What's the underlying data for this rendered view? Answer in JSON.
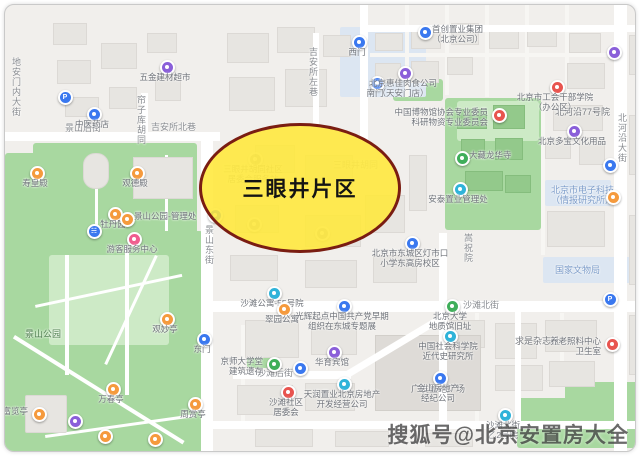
{
  "map": {
    "highlight": {
      "label": "三眼井片区",
      "cx": 292,
      "cy": 180,
      "rx": 98,
      "ry": 62
    },
    "watermark": {
      "text": "搜狐号@北京安置房大全"
    },
    "street_labels": [
      {
        "text": "地安门内大街",
        "x": 6,
        "y": 52,
        "vertical": true
      },
      {
        "text": "帘子库胡同",
        "x": 131,
        "y": 90,
        "vertical": true
      },
      {
        "text": "吉安所左巷",
        "x": 303,
        "y": 42,
        "vertical": true
      },
      {
        "text": "景山后街",
        "x": 60,
        "y": 119,
        "vertical": false
      },
      {
        "text": "吉安所北巷",
        "x": 146,
        "y": 118,
        "vertical": false
      },
      {
        "text": "景山东街",
        "x": 199,
        "y": 220,
        "vertical": true
      },
      {
        "text": "北河沿大街",
        "x": 612,
        "y": 108,
        "vertical": true
      },
      {
        "text": "嵩祝院",
        "x": 458,
        "y": 228,
        "vertical": true
      },
      {
        "text": "沙滩北街",
        "x": 458,
        "y": 296,
        "vertical": false
      },
      {
        "text": "沙滩后街",
        "x": 252,
        "y": 364,
        "vertical": false
      },
      {
        "text": "三眼井胡同",
        "x": 328,
        "y": 156,
        "vertical": false,
        "faint": true
      }
    ],
    "area_labels": [
      {
        "lines": [
          "北河沿77号院"
        ],
        "x": 550,
        "y": 102,
        "color": "label_gray"
      },
      {
        "lines": [
          "北京市电子科技",
          "（情报研究所）"
        ],
        "x": 546,
        "y": 180,
        "color": "label_blue"
      },
      {
        "lines": [
          "国家文物局"
        ],
        "x": 550,
        "y": 260,
        "color": "label_blue"
      },
      {
        "lines": [
          "求是杂志社"
        ],
        "x": 510,
        "y": 331,
        "color": "label_gray"
      },
      {
        "lines": [
          "广发置地广场"
        ],
        "x": 406,
        "y": 379,
        "color": "label_gray"
      },
      {
        "lines": [
          "景山公园"
        ],
        "x": 20,
        "y": 324,
        "color": "label_green"
      }
    ],
    "pois": [
      {
        "x": 58,
        "y": 90,
        "color": "pin_blue",
        "glyph": "P",
        "lines": []
      },
      {
        "x": 87,
        "y": 107,
        "color": "pin_blue",
        "lines": [
          "中医药店"
        ]
      },
      {
        "x": 160,
        "y": 60,
        "color": "pin_purple",
        "lines": [
          "五金建材超市"
        ]
      },
      {
        "x": 352,
        "y": 35,
        "color": "pin_blue",
        "lines": [
          "西门"
        ]
      },
      {
        "x": 370,
        "y": 76,
        "color": "pin_blue",
        "lines": [
          "南门"
        ]
      },
      {
        "x": 398,
        "y": 66,
        "color": "pin_purple",
        "lines": [
          "北京惠佳肉食公司",
          "（天安门店）"
        ]
      },
      {
        "x": 418,
        "y": 25,
        "color": "pin_blue",
        "side": "right",
        "lines": [
          "首创置业集团",
          "（北京公司）"
        ]
      },
      {
        "x": 607,
        "y": 45,
        "color": "pin_purple",
        "lines": []
      },
      {
        "x": 550,
        "y": 80,
        "color": "pin_red",
        "lines": [
          "北京市工会干部学院",
          "（办公区）"
        ]
      },
      {
        "x": 567,
        "y": 124,
        "color": "pin_purple",
        "lines": [
          "北京多宝文化用品"
        ]
      },
      {
        "x": 455,
        "y": 151,
        "color": "pin_green",
        "side": "right",
        "lines": [
          "大藏龙华寺"
        ]
      },
      {
        "x": 453,
        "y": 182,
        "color": "pin_cyan",
        "lines": [
          "安泰置业管理处"
        ]
      },
      {
        "x": 492,
        "y": 108,
        "color": "pin_red",
        "side": "left",
        "lines": [
          "中国博物馆协会专业委员",
          "科研物资专业委员会"
        ]
      },
      {
        "x": 603,
        "y": 158,
        "color": "pin_blue",
        "lines": []
      },
      {
        "x": 606,
        "y": 190,
        "color": "pin_orange",
        "lines": []
      },
      {
        "x": 405,
        "y": 236,
        "color": "pin_blue",
        "lines": [
          "北京市东城区灯市口",
          "小学东高房校区"
        ]
      },
      {
        "x": 208,
        "y": 208,
        "color": "pin_blue",
        "lines": []
      },
      {
        "x": 267,
        "y": 286,
        "color": "pin_cyan",
        "lines": [
          "沙滩公寓-55号院"
        ]
      },
      {
        "x": 277,
        "y": 302,
        "color": "pin_orange",
        "lines": [
          "翠园公寓"
        ]
      },
      {
        "x": 337,
        "y": 299,
        "color": "pin_blue",
        "lines": [
          "光辉起点中国共产党早期",
          "组织在东城专题展"
        ]
      },
      {
        "x": 267,
        "y": 357,
        "color": "pin_green",
        "side": "left",
        "lines": [
          "京师大学堂",
          "建筑遗存"
        ]
      },
      {
        "x": 293,
        "y": 361,
        "color": "pin_blue",
        "lines": []
      },
      {
        "x": 327,
        "y": 345,
        "color": "pin_purple",
        "lines": [
          "华育宾馆"
        ]
      },
      {
        "x": 337,
        "y": 377,
        "color": "pin_cyan",
        "lines": [
          "天润置业北京房地产",
          "开发经营公司"
        ]
      },
      {
        "x": 281,
        "y": 385,
        "color": "pin_red",
        "lines": [
          "沙滩社区",
          "居委会"
        ]
      },
      {
        "x": 445,
        "y": 299,
        "color": "pin_green",
        "lines": [
          "北京大学",
          "地质馆旧址"
        ]
      },
      {
        "x": 443,
        "y": 329,
        "color": "pin_cyan",
        "lines": [
          "中国社会科学院",
          "近代史研究所"
        ]
      },
      {
        "x": 605,
        "y": 337,
        "color": "pin_red",
        "side": "left",
        "lines": [
          "养老照料中心",
          "卫生室"
        ]
      },
      {
        "x": 433,
        "y": 371,
        "color": "pin_blue",
        "lines": [
          "金山房地产",
          "经纪公司"
        ]
      },
      {
        "x": 498,
        "y": 408,
        "color": "pin_cyan",
        "lines": [
          "沙滩北街",
          "乙2号院"
        ]
      },
      {
        "x": 603,
        "y": 292,
        "color": "pin_blue",
        "glyph": "P",
        "lines": []
      },
      {
        "x": 197,
        "y": 332,
        "color": "pin_blue",
        "lines": [
          "东门"
        ]
      },
      {
        "x": 30,
        "y": 166,
        "color": "pin_orange",
        "lines": [
          "寿皇殿"
        ]
      },
      {
        "x": 130,
        "y": 166,
        "color": "pin_orange",
        "lines": [
          "观德殿"
        ]
      },
      {
        "x": 108,
        "y": 207,
        "color": "pin_orange",
        "lines": [
          "牡丹园"
        ]
      },
      {
        "x": 120,
        "y": 212,
        "color": "pin_orange",
        "side": "right",
        "lines": [
          "景山公园-管理处"
        ]
      },
      {
        "x": 87,
        "y": 224,
        "color": "pin_blue",
        "glyph": "wc",
        "lines": []
      },
      {
        "x": 127,
        "y": 232,
        "color": "pin_pink",
        "lines": [
          "游客服务中心"
        ]
      },
      {
        "x": 160,
        "y": 312,
        "color": "pin_orange",
        "lines": [
          "观妙亭"
        ]
      },
      {
        "x": 106,
        "y": 382,
        "color": "pin_orange",
        "lines": [
          "万春亭"
        ]
      },
      {
        "x": 188,
        "y": 397,
        "color": "pin_orange",
        "lines": [
          "周赏亭"
        ]
      },
      {
        "x": 32,
        "y": 407,
        "color": "pin_orange",
        "side": "left",
        "lines": [
          "富览亭"
        ]
      },
      {
        "x": 68,
        "y": 414,
        "color": "pin_purple",
        "lines": []
      },
      {
        "x": 98,
        "y": 429,
        "color": "pin_orange",
        "lines": []
      },
      {
        "x": 148,
        "y": 432,
        "color": "pin_orange",
        "lines": []
      },
      {
        "x": 248,
        "y": 152,
        "color": "pin_gray",
        "faint": true,
        "lines": [
          "三眼井胡同社区",
          "居委会服务站"
        ]
      },
      {
        "x": 247,
        "y": 217,
        "color": "pin_gray",
        "faint": true,
        "lines": []
      },
      {
        "x": 315,
        "y": 226,
        "color": "pin_gray",
        "faint": true,
        "lines": []
      }
    ],
    "colors": {
      "highlight_fill": "#FFE83A",
      "highlight_border": "#7A1D12",
      "park": "#A8D8A0",
      "park_light": "#CDEAC6",
      "campus_blue": "#DCE6F2",
      "road": "#FFFFFF",
      "building": "#E7E5E1",
      "pin_blue": "#3A78EF",
      "pin_cyan": "#2FB3D9",
      "pin_purple": "#8A5FD9",
      "pin_orange": "#F59A3D",
      "pin_red": "#E8544F",
      "pin_green": "#3FAE5A",
      "pin_pink": "#EF5D8F",
      "pin_gray": "#9AA0A6",
      "label_gray": "#75787D",
      "label_blue": "#7C9CC9",
      "label_green": "#4E7D4E"
    }
  }
}
